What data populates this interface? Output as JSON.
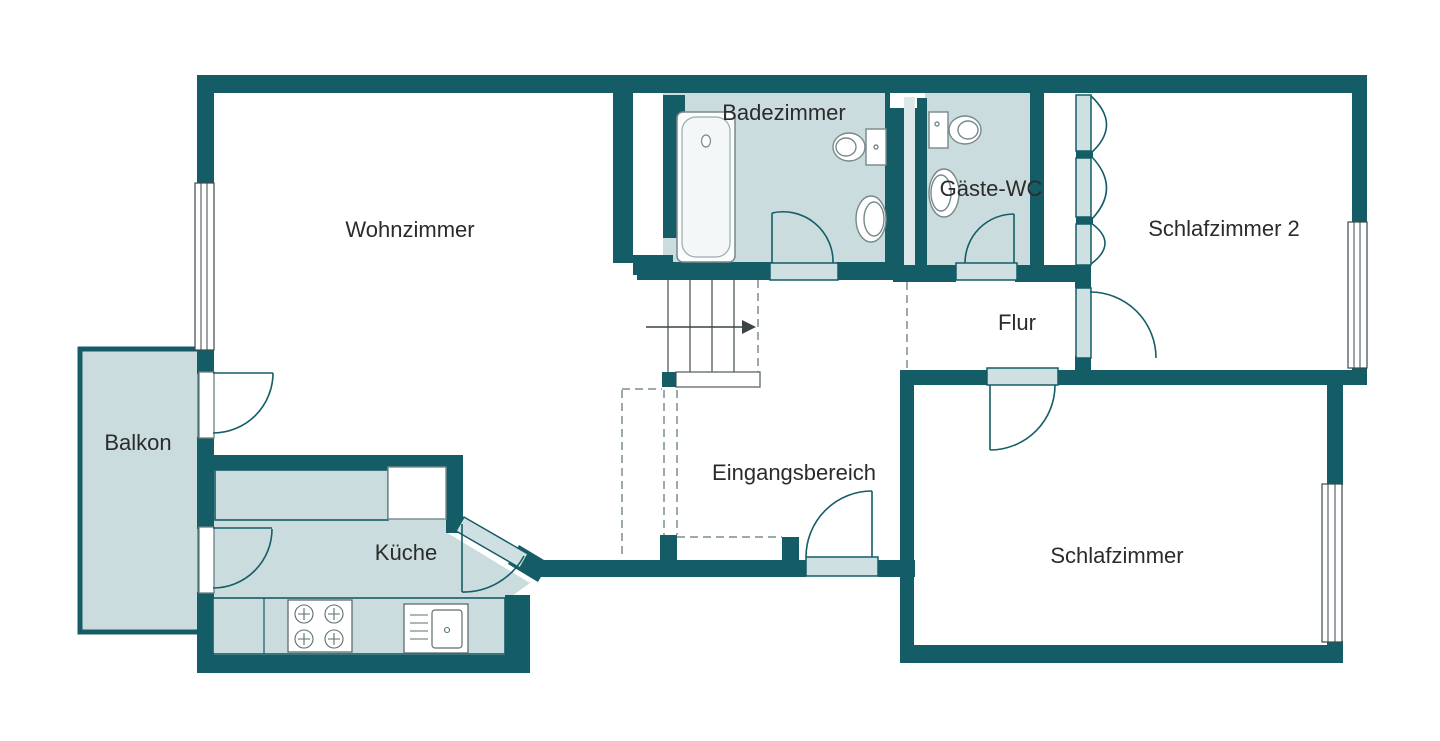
{
  "floorplan": {
    "rooms": [
      {
        "id": "wohnzimmer",
        "label": "Wohnzimmer"
      },
      {
        "id": "badezimmer",
        "label": "Badezimmer"
      },
      {
        "id": "gaeste-wc",
        "label": "Gäste-WC"
      },
      {
        "id": "schlafzimmer-2",
        "label": "Schlafzimmer 2"
      },
      {
        "id": "flur",
        "label": "Flur"
      },
      {
        "id": "balkon",
        "label": "Balkon"
      },
      {
        "id": "kueche",
        "label": "Küche"
      },
      {
        "id": "eingangsbereich",
        "label": "Eingangsbereich"
      },
      {
        "id": "schlafzimmer",
        "label": "Schlafzimmer"
      }
    ],
    "fixtures": [
      "bathtub",
      "toilet",
      "washbasin",
      "guest-toilet",
      "guest-washbasin",
      "stove",
      "kitchen-sink",
      "kitchen-counter",
      "stairs-up-arrow",
      "built-in-closet"
    ],
    "colors": {
      "wall": "#155d66",
      "room_fill": "#cbdcde",
      "sill_fill": "#cfe0e2",
      "shaft_fill": "#dce8e9",
      "fixture_stroke": "#76898b",
      "dash": "#7c8e90",
      "text": "#2b2b2b",
      "background": "#ffffff"
    }
  }
}
